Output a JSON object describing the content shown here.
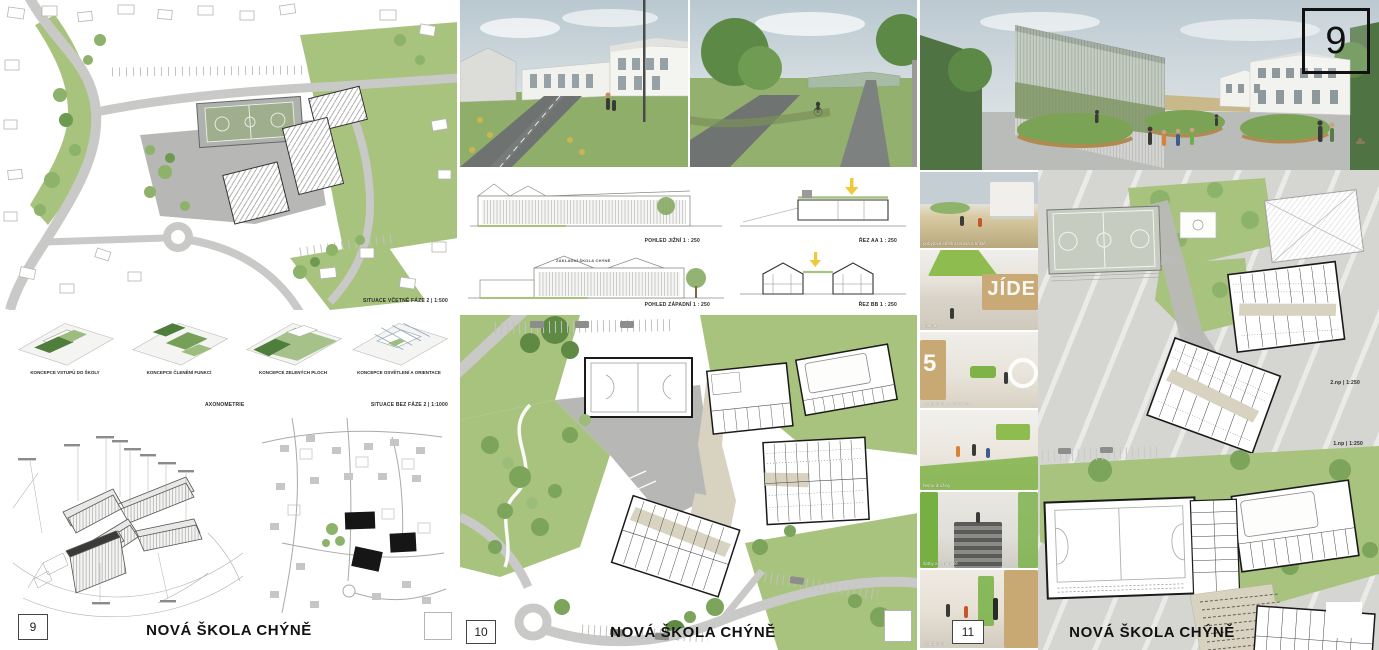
{
  "poster_title": "NOVÁ ŠKOLA CHÝNĚ",
  "colors": {
    "lawn_green": "#a8c37e",
    "tree_green": "#7ca45b",
    "dark_green": "#4f7342",
    "concept_dark_green": "#4e7d3c",
    "concept_light_green": "#9dbd7e",
    "plaza_gray": "#b7b7b5",
    "road_gray": "#c9c9c7",
    "corridor_beige": "#d8d2c0",
    "line_black": "#1a1a1a",
    "daylight_yellow": "#f0c93a",
    "board3_background": "#d5d5d2",
    "accent_interior_green": "#7fb347"
  },
  "boards": {
    "left": {
      "panel_number": "9",
      "title": "NOVÁ ŠKOLA CHÝNĚ",
      "site_plan_label": "SITUACE VČETNĚ FÁZE 2 | 1:500",
      "axonometry_label": "AXONOMETRIE",
      "site_plan2_label": "SITUACE BEZ FÁZE 2 | 1:1000",
      "concepts": [
        {
          "label": "KONCEPCE VSTUPŮ DO ŠKOLY"
        },
        {
          "label": "KONCEPCE ČLENĚNÍ FUNKCÍ"
        },
        {
          "label": "KONCEPCE ZELENÝCH PLOCH"
        },
        {
          "label": "KONCEPCE OSVĚTLENÍ A ORIENTACE"
        }
      ]
    },
    "middle": {
      "panel_number": "10",
      "title": "NOVÁ ŠKOLA CHÝNĚ",
      "south_elevation_label": "POHLED JIŽNÍ 1 : 250",
      "section_aa_label": "ŘEZ AA 1 : 250",
      "west_elevation_label": "POHLED ZÁPADNÍ 1 : 250",
      "section_bb_label": "ŘEZ BB 1 : 250",
      "facade_text": "ZÁKLADNÍ ŠKOLA CHÝNĚ"
    },
    "right": {
      "panel_number": "11",
      "sheet_number": "9",
      "title": "NOVÁ ŠKOLA CHÝNĚ",
      "floor2_label": "2.np | 1:250",
      "floor1_label": "1.np | 1:250",
      "interior_views": [
        {
          "caption": "pobytová střešní terasa a hřiště"
        },
        {
          "caption": "jídelna",
          "supergraphic": "JÍDE"
        },
        {
          "caption": "vstupní hala a knihovna",
          "supergraphic": "5"
        },
        {
          "caption": "herna družiny"
        },
        {
          "caption": "šatny a schodiště"
        },
        {
          "caption": "vstupní hala"
        }
      ]
    }
  }
}
